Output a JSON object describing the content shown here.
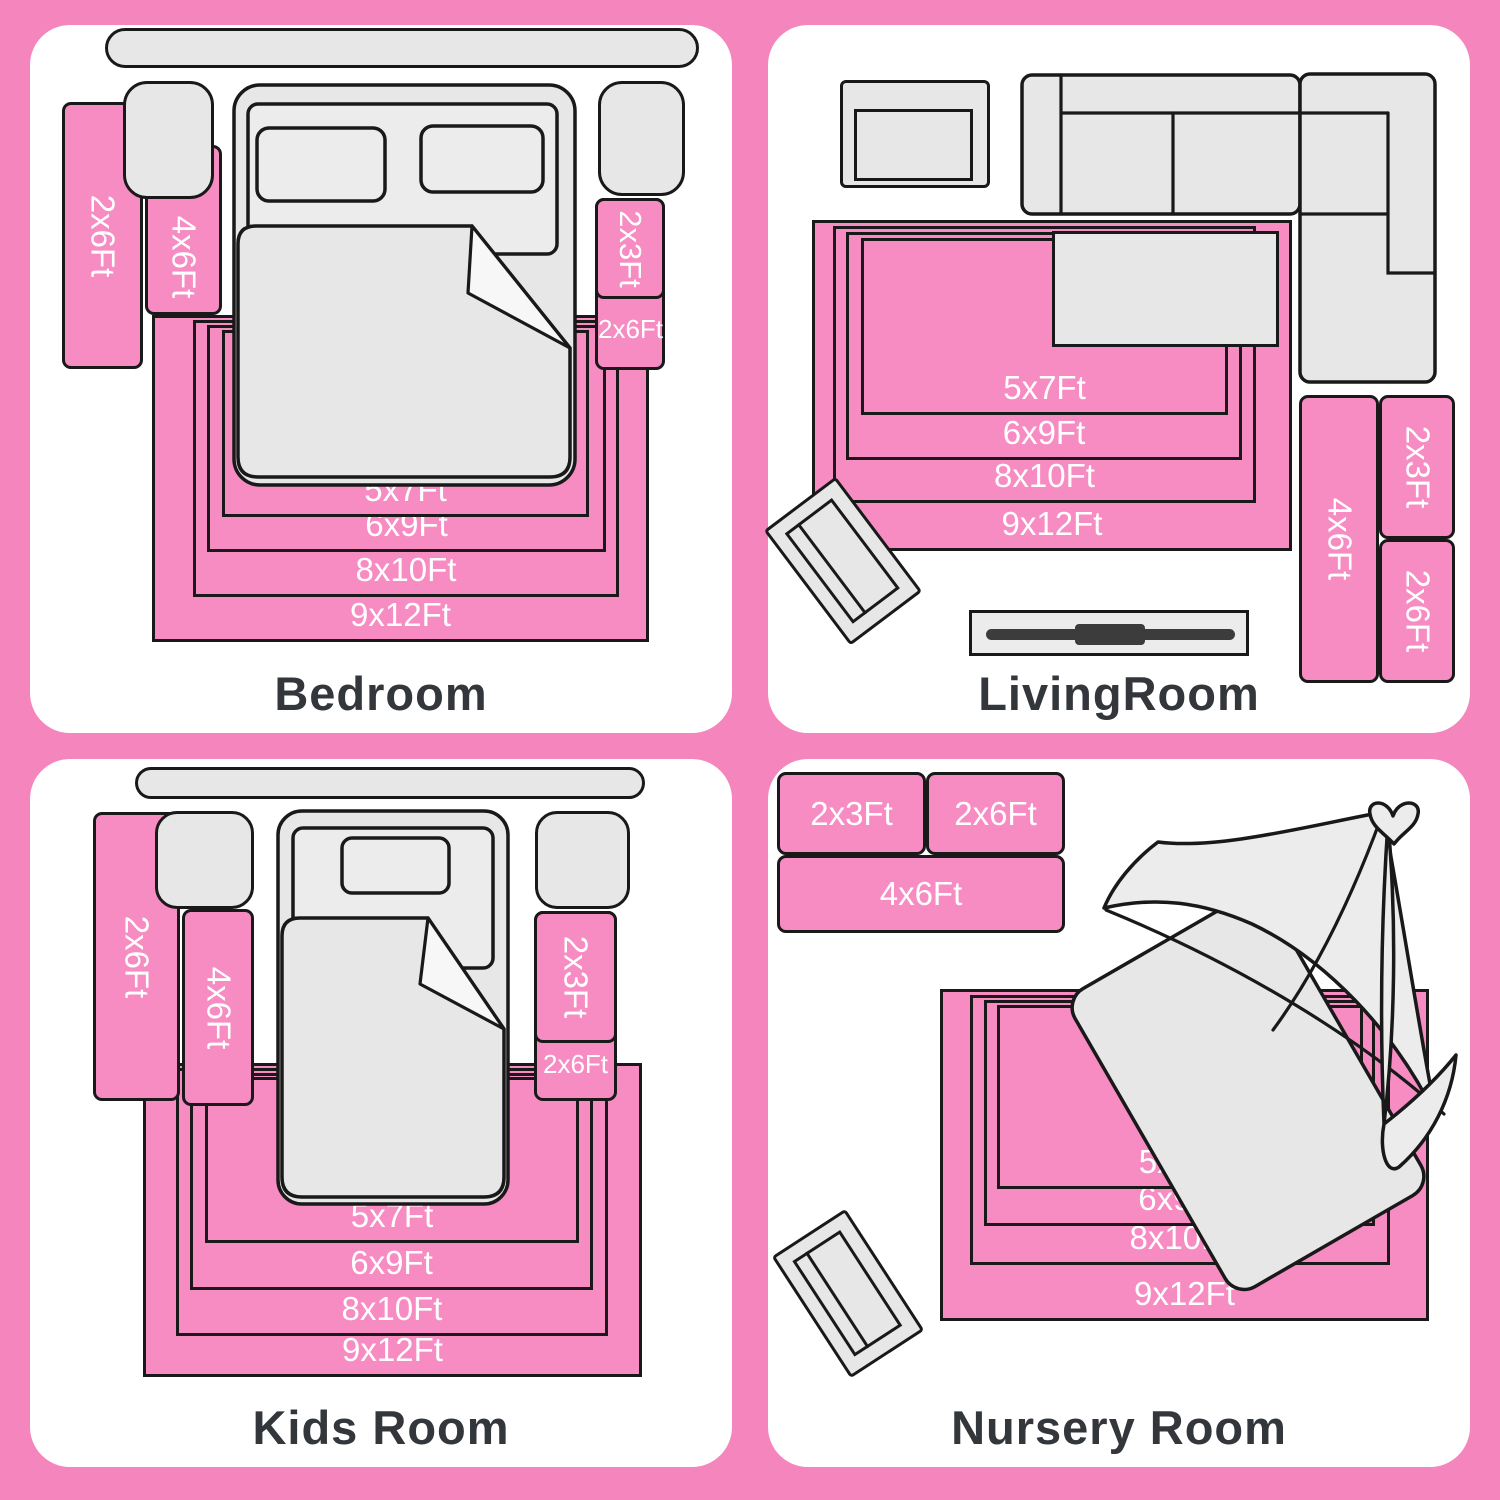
{
  "colors": {
    "page_bg": "#f485bd",
    "panel_bg": "#ffffff",
    "rug_pink": "#f78cc3",
    "furniture_gray": "#e7e7e7",
    "outline": "#191919",
    "title_color": "#33373c",
    "label_color": "#ffffff"
  },
  "panels": {
    "bedroom": {
      "title": "Bedroom",
      "rugs": {
        "left_2x6": "2x6Ft",
        "left_4x6": "4x6Ft",
        "right_2x3": "2x3Ft",
        "right_2x6": "2x6Ft"
      },
      "nested": [
        "5x7Ft",
        "6x9Ft",
        "8x10Ft",
        "9x12Ft"
      ]
    },
    "livingroom": {
      "title": "LivingRoom",
      "rugs": {
        "right_4x6": "4x6Ft",
        "right_2x3": "2x3Ft",
        "right_2x6": "2x6Ft"
      },
      "nested": [
        "5x7Ft",
        "6x9Ft",
        "8x10Ft",
        "9x12Ft"
      ]
    },
    "kidsroom": {
      "title": "Kids Room",
      "rugs": {
        "left_2x6": "2x6Ft",
        "left_4x6": "4x6Ft",
        "right_2x3": "2x3Ft",
        "right_2x6": "2x6Ft"
      },
      "nested": [
        "5x7Ft",
        "6x9Ft",
        "8x10Ft",
        "9x12Ft"
      ]
    },
    "nursery": {
      "title": "Nursery Room",
      "rugs": {
        "top_2x3": "2x3Ft",
        "top_2x6": "2x6Ft",
        "top_4x6": "4x6Ft"
      },
      "nested": [
        "5x7Ft",
        "6x9Ft",
        "8x10Ft",
        "9x12Ft"
      ]
    }
  }
}
